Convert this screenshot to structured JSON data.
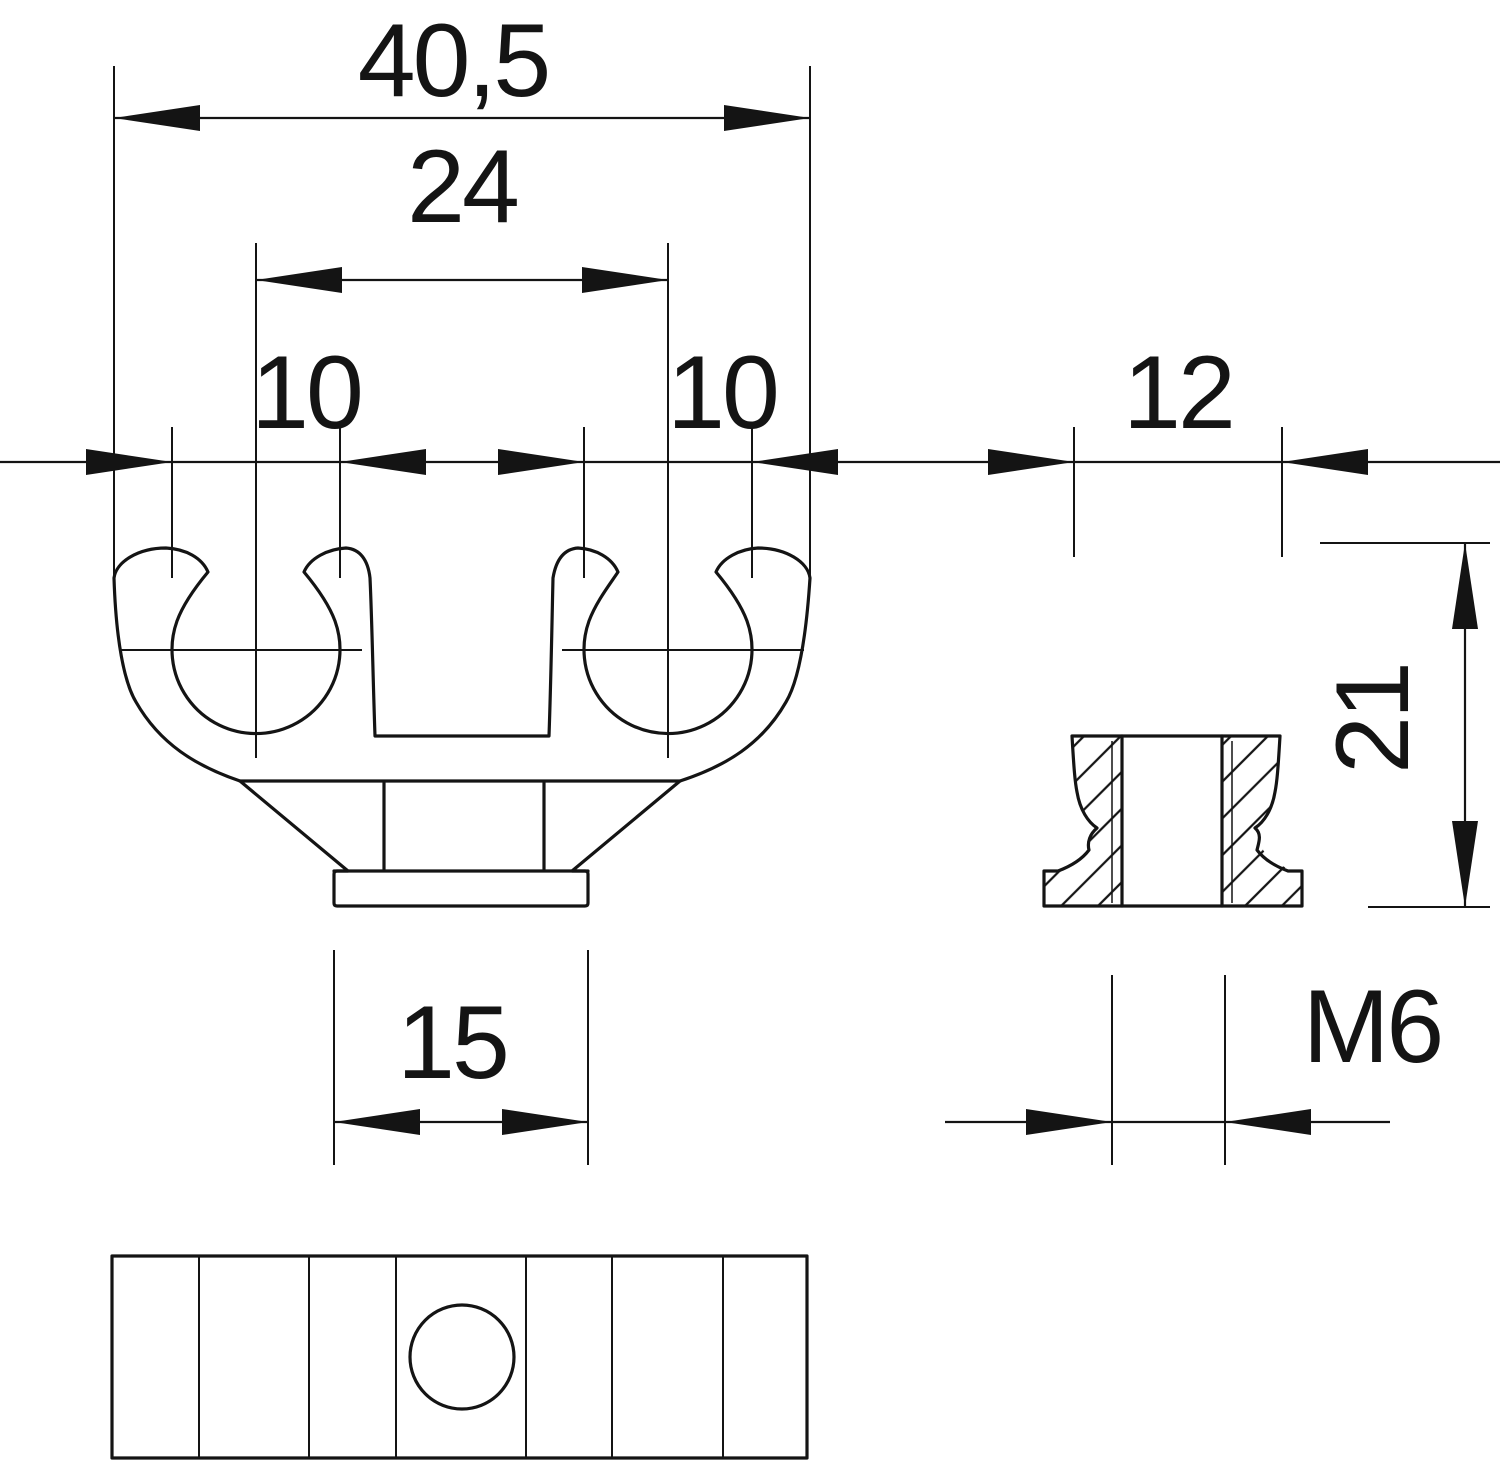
{
  "drawing": {
    "kind": "technical-drawing-pipe-clamp",
    "colors": {
      "background": "#ffffff",
      "line": "#141414"
    },
    "dims": {
      "overall_width": {
        "label": "40,5"
      },
      "clip_spacing": {
        "label": "24"
      },
      "bore_left": {
        "label": "10"
      },
      "bore_right": {
        "label": "10"
      },
      "side_width": {
        "label": "12"
      },
      "height": {
        "label": "21"
      },
      "foot_width": {
        "label": "15"
      },
      "thread": {
        "label": "M6"
      }
    }
  }
}
